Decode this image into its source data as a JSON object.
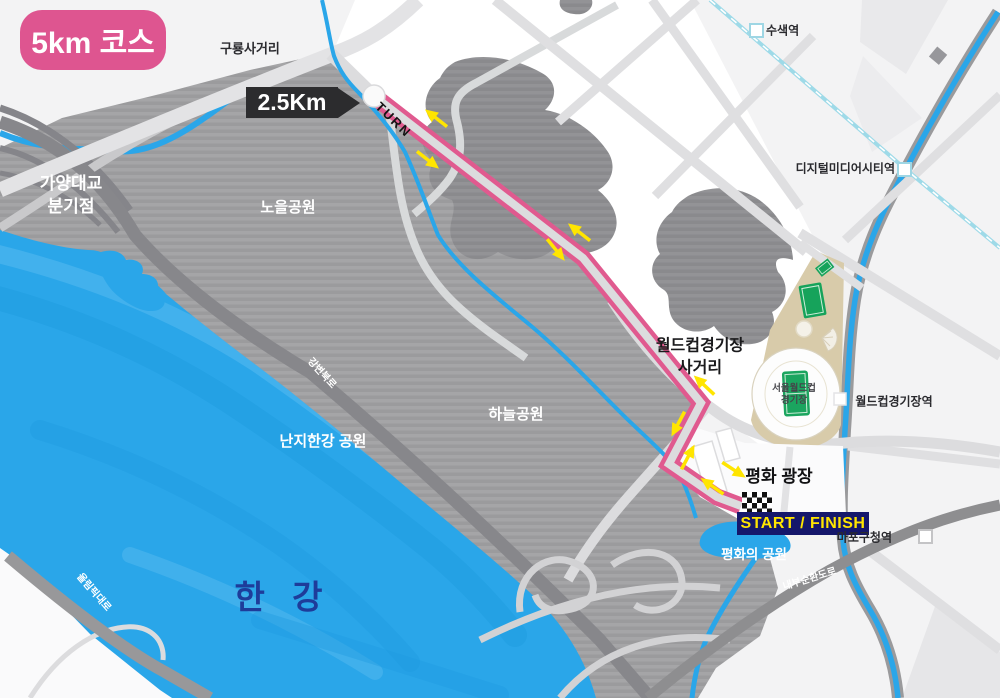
{
  "title_badge": "5km 코스",
  "course": {
    "distance_marker": "2.5Km",
    "turn_label": "TURN",
    "start_finish": "START / FINISH"
  },
  "places": {
    "guryong_junction": "구룡사거리",
    "gayang_line1": "가양대교",
    "gayang_line2": "분기점",
    "noeul_park": "노을공원",
    "haneul_park": "하늘공원",
    "nanji_park": "난지한강 공원",
    "han_river": "한 강",
    "worldcup_junction_line1": "월드컵경기장",
    "worldcup_junction_line2": "사거리",
    "stadium_line1": "서울월드컵",
    "stadium_line2": "경기장",
    "peace_plaza": "평화 광장",
    "peace_park": "평화의 공원"
  },
  "roads": {
    "gangbyeon_expwy": "강변북로",
    "olympic_expwy": "올림픽대로",
    "naebu_ring_road": "내부순환도로"
  },
  "stations": {
    "susaek": "수색역",
    "dmc": "디지털미디어시티역",
    "worldcup_stadium": "월드컵경기장역",
    "mapo_gu_office": "마포구청역"
  },
  "colors": {
    "course_pink": "#E05A8F",
    "arrow_yellow": "#FFE500",
    "river_blue": "#2AA6E9",
    "start_finish_navy": "#15176B",
    "stadium_tan": "#D8CBAA",
    "field_green": "#16A35B"
  }
}
